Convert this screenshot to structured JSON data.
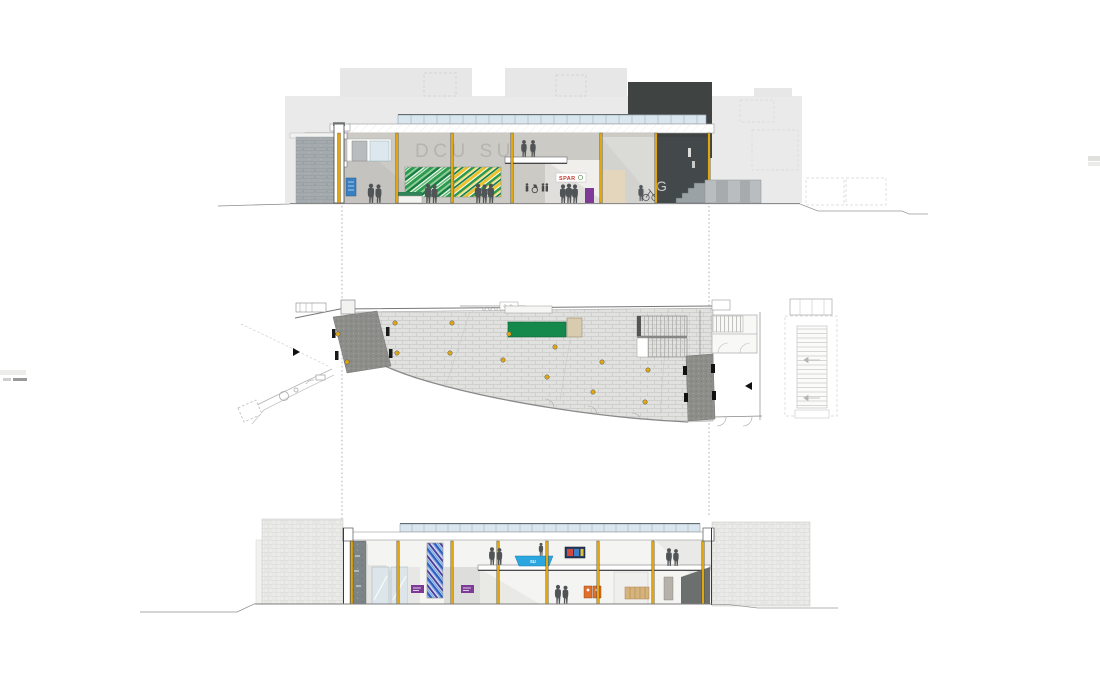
{
  "labels": {
    "building_sign": "DCU SU",
    "shop_sign": "SPAR",
    "stair_letter": "G",
    "desk_sign": "SU"
  },
  "colors": {
    "accent_yellow": "#E2A70E",
    "charcoal": "#3F4443",
    "mural_green": "#2C9B4E",
    "mural_green_dark": "#157F3D",
    "mural_yellow": "#EEC22E",
    "mosaic_blue": "#2E5FC0",
    "mosaic_violet": "#4A3A9C",
    "purple_sign": "#7D3A96",
    "desk_blue": "#2BA6DE",
    "desk_green": "#15884B",
    "spar_red": "#C03A2E",
    "orange_unit": "#E2702A",
    "glazing_blue": "#D9E6EF",
    "poster_blue": "#3A7FC1",
    "dark_bay": "#43484A",
    "ground_line": "#8A8A8A"
  }
}
